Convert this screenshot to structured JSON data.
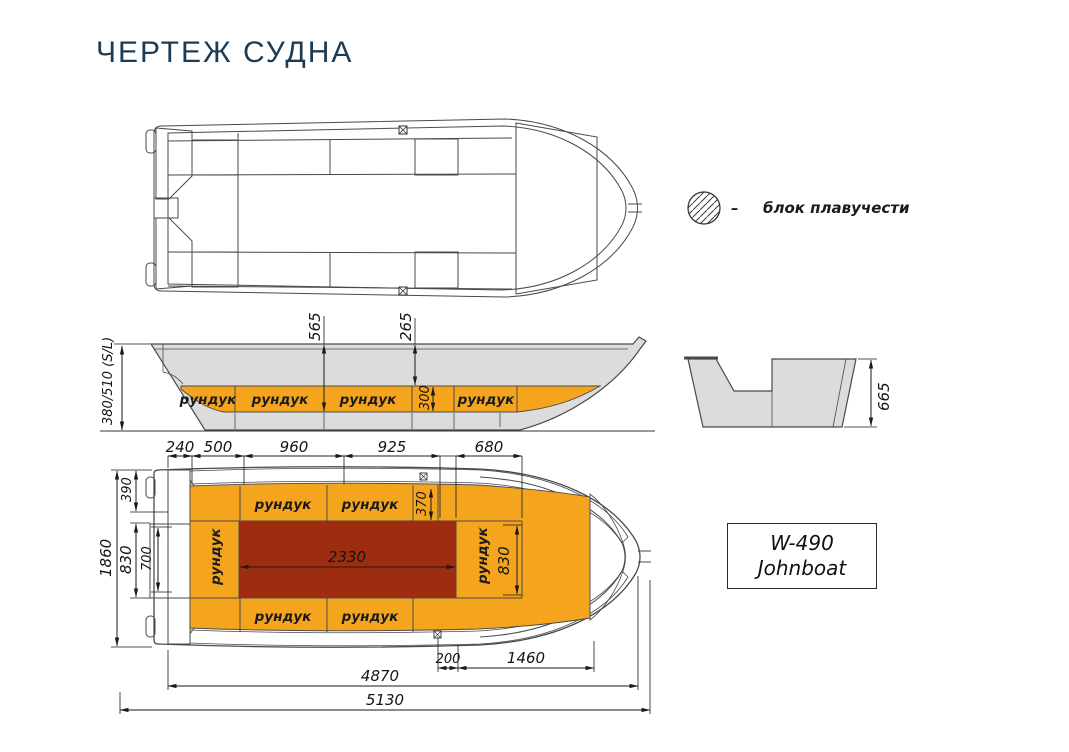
{
  "title": "ЧЕРТЕЖ СУДНА",
  "legend": {
    "dash": "–",
    "label": "блок плавучести"
  },
  "model": {
    "line1": "W-490",
    "line2": "Johnboat"
  },
  "colors": {
    "orange": "#f5a51d",
    "cockpit_red": "#9e2d10",
    "hull_gray": "#dcdcdc",
    "title_navy": "#1c3c55"
  },
  "side_view": {
    "height_label": "380/510 (S/L)",
    "dim_565": "565",
    "dim_265": "265",
    "dim_300": "300",
    "lockers": [
      "рундук",
      "рундук",
      "рундук",
      "рундук"
    ]
  },
  "transom_view": {
    "dim_665": "665"
  },
  "plan_view": {
    "top_dims": [
      "240",
      "500",
      "960",
      "925",
      "680"
    ],
    "left_dims": {
      "d1860": "1860",
      "d390": "390",
      "d830": "830",
      "d700": "700"
    },
    "inner_dims": {
      "d370": "370",
      "d2330": "2330",
      "d830": "830"
    },
    "bottom_dims": {
      "d200": "200",
      "d1460": "1460",
      "d4870": "4870",
      "d5130": "5130"
    },
    "lockers_top": [
      "рундук",
      "рундук"
    ],
    "lockers_bottom": [
      "рундук",
      "рундук"
    ],
    "locker_left": "рундук",
    "locker_right": "рундук"
  }
}
